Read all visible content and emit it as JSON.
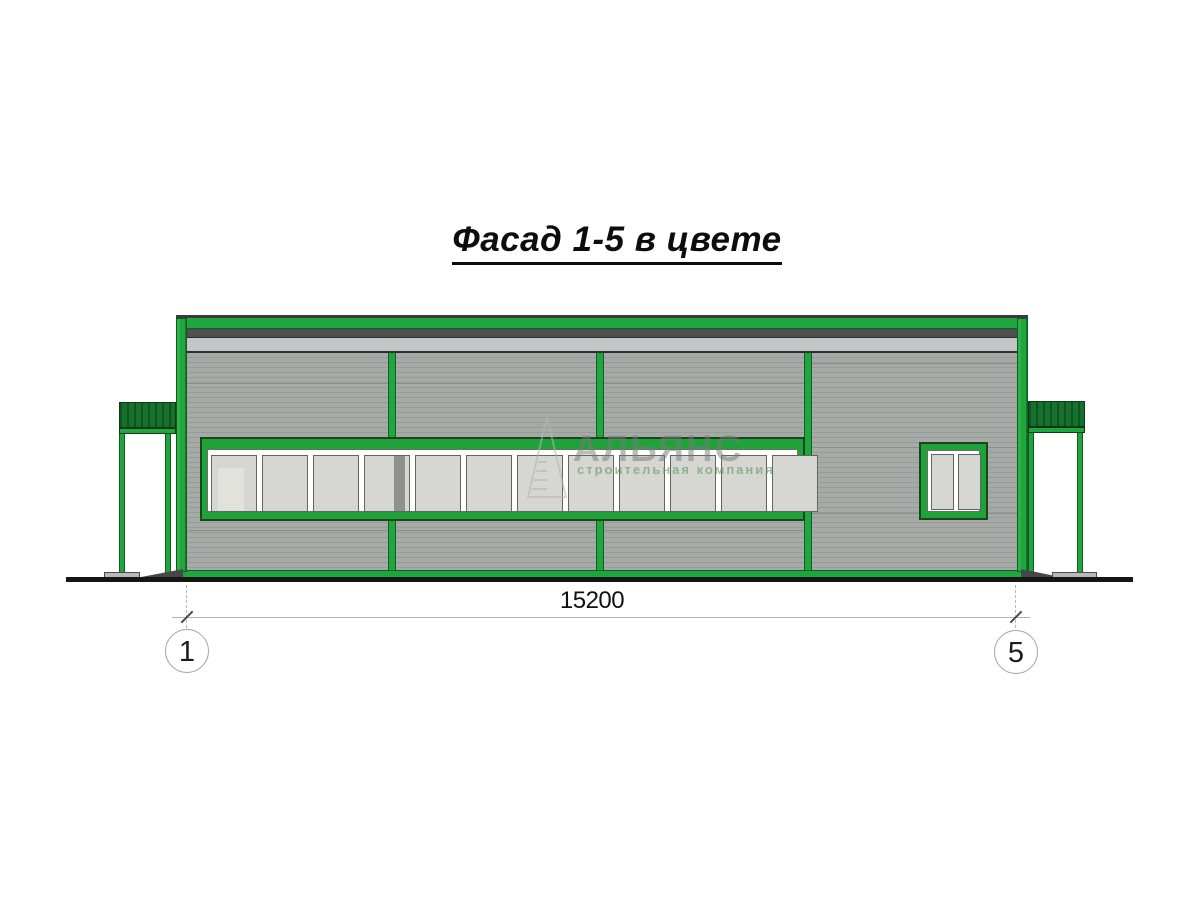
{
  "title": {
    "text": "Фасад 1-5 в цвете"
  },
  "dimension": {
    "value": "15200",
    "axis_left": "1",
    "axis_right": "5"
  },
  "watermark": {
    "name": "АЛЬЯНС",
    "tagline": "строительная компания",
    "logo": "triangle-alliance-logo"
  },
  "facade": {
    "bays": 4,
    "ribbon_window": {
      "pane_count": 12
    },
    "small_window": {
      "pane_count": 2
    },
    "elements": [
      "roof-band",
      "corner-columns",
      "mullions",
      "ribbon-window",
      "small-window",
      "left-canopy",
      "right-canopy",
      "ground-line",
      "entrance-ramps"
    ]
  },
  "colors": {
    "frame_green": "#21a53e",
    "frame_green_dark": "#0e6120",
    "canopy_green": "#17712c",
    "wall_gray": "#a0a4a1",
    "parapet_dark_gray": "#4e5050",
    "parapet_light_gray": "#c4c5c7",
    "glass_gray": "#d6d7d3",
    "ground_black": "#161616"
  }
}
